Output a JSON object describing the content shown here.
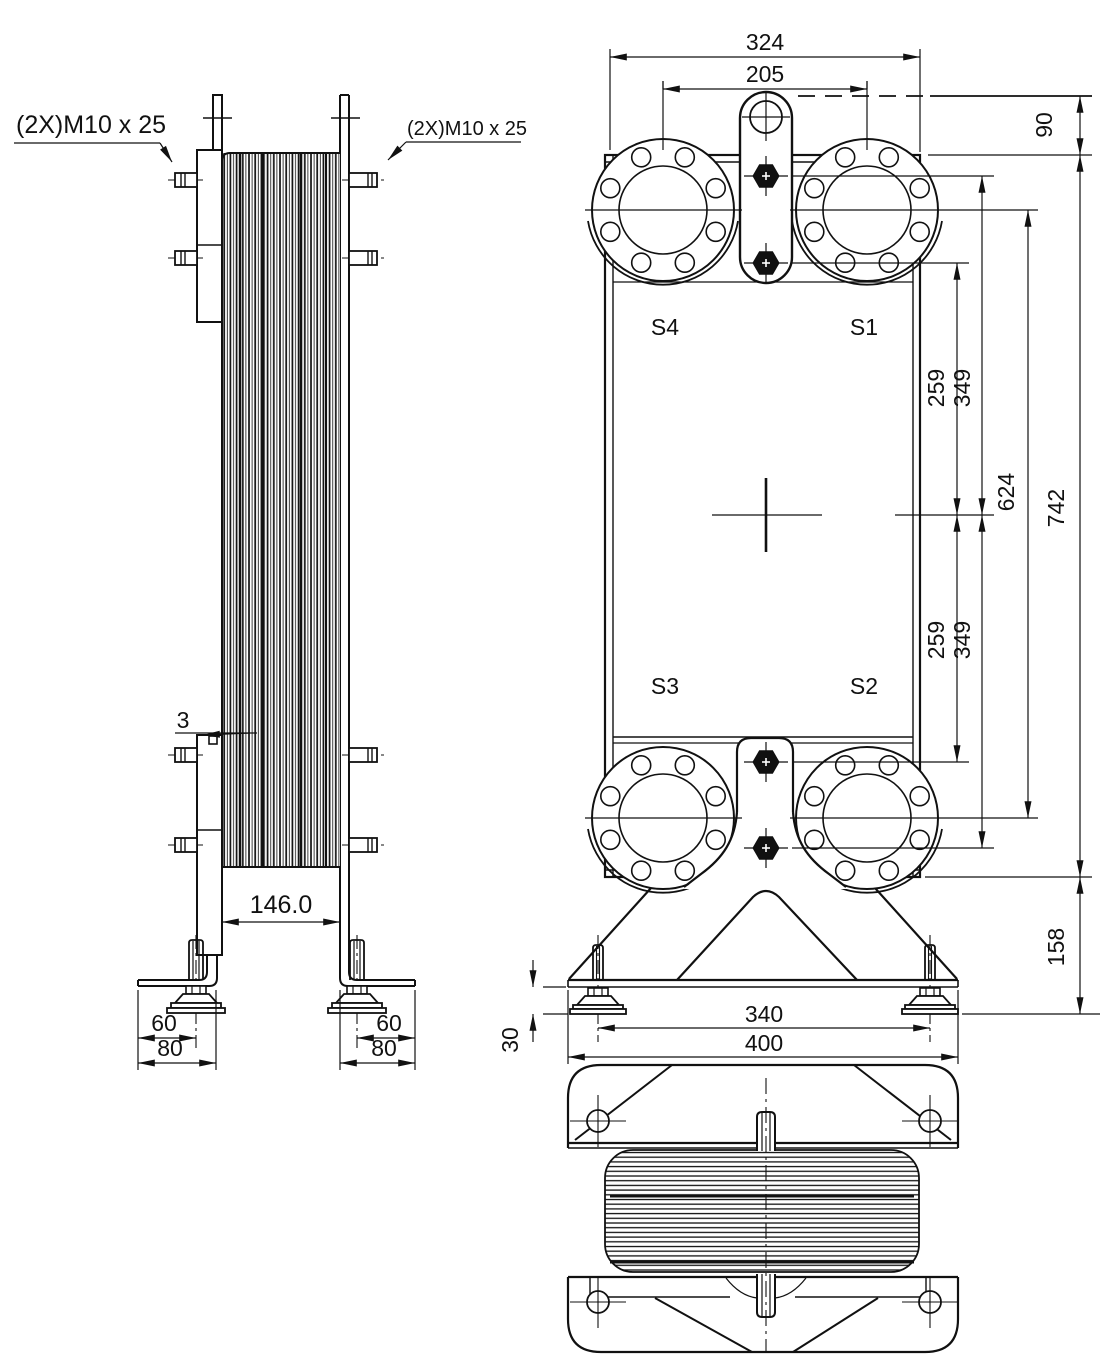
{
  "side_view": {
    "bolt_note_left": "(2X)M10 x 25",
    "bolt_note_right": "(2X)M10 x 25",
    "dims": {
      "frame_plate_tab": "3",
      "stack_depth": "146.0",
      "foot_stud_offset": "60",
      "foot_bracket_width": "80"
    }
  },
  "front_view": {
    "ports": {
      "s1": "S1",
      "s2": "S2",
      "s3": "S3",
      "s4": "S4"
    },
    "dims": {
      "overall_width": "324",
      "port_spacing_horizontal": "205",
      "top_to_plate": "90",
      "center_to_inner_bolt": "259",
      "center_to_outer_bolt": "349",
      "port_spacing_vertical": "624",
      "plate_height": "742",
      "plate_bottom_to_floor": "158",
      "foot_pad_height": "30",
      "foot_spacing": "340",
      "base_width": "400"
    }
  }
}
